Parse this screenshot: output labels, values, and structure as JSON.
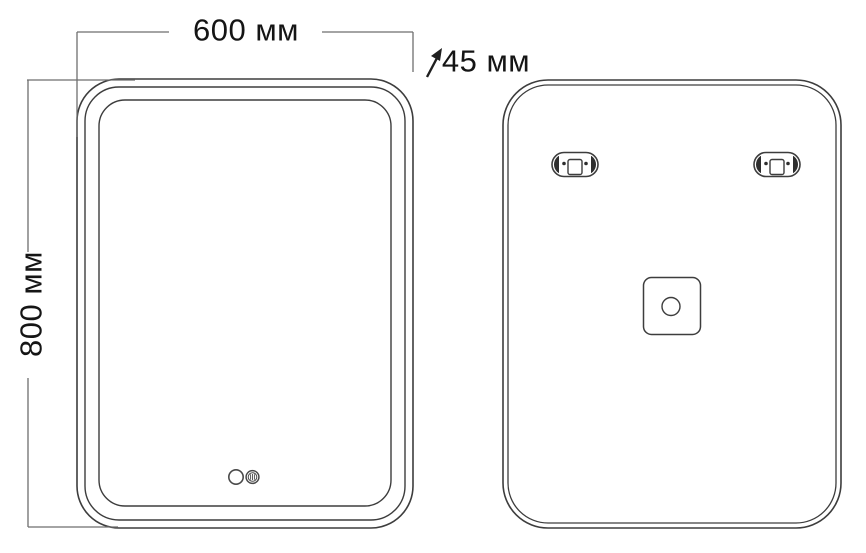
{
  "diagram": {
    "dimensions": {
      "width_label": "600 мм",
      "depth_label": "45 мм",
      "height_label": "800 мм"
    },
    "icons": {
      "depth_arrow": "diagonal-arrow-up-right",
      "power_touch": "circle-outline-touch-sensor",
      "demister_touch": "circle-with-bars-touch-sensor",
      "mounting_bracket": "pill-bracket-with-screw-holes-and-slot",
      "junction_box": "rounded-square-with-round-hole"
    },
    "colors": {
      "background": "#ffffff",
      "outline": "#3d3d3d",
      "dimension_line": "#6e6e6e",
      "text": "#151515",
      "bracket_cap": "#2e2e2e"
    }
  }
}
